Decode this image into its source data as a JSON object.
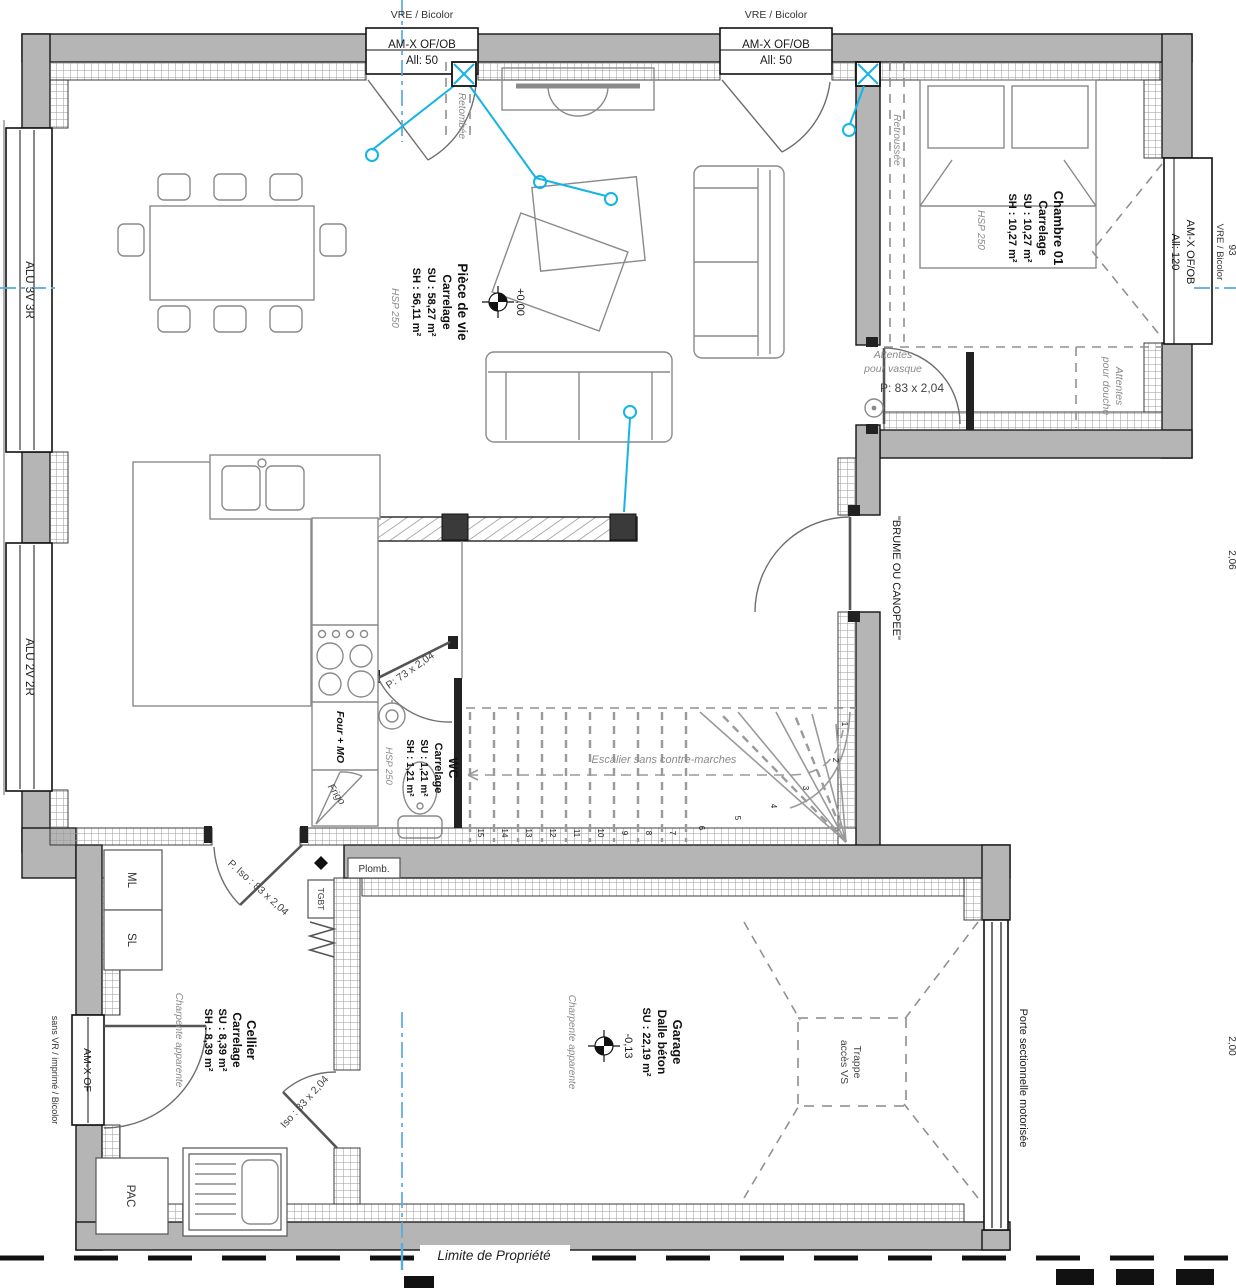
{
  "rooms": {
    "piece_de_vie": {
      "name": "Pièce de vie",
      "finish": "Carrelage",
      "su": "SU : 58,27 m²",
      "sh": "SH : 56,11 m²",
      "hsp": "HSP 250"
    },
    "chambre": {
      "name": "Chambre 01",
      "finish": "Carrelage",
      "su": "SU : 10,27 m²",
      "sh": "SH : 10,27 m²",
      "hsp": "HSP 250"
    },
    "wc": {
      "name": "WC",
      "finish": "Carrelage",
      "su": "SU : 1,21 m²",
      "sh": "SH : 1,21 m²",
      "hsp": "HSP 250"
    },
    "cellier": {
      "name": "Cellier",
      "finish": "Carrelage",
      "su": "SU : 8,39 m²",
      "sh": "SH : 8,39 m²",
      "note": "Charpente apparente"
    },
    "garage": {
      "name": "Garage",
      "finish": "Dalle béton",
      "su": "SU : 22,19 m²",
      "note": "Charpente apparente"
    }
  },
  "levels": {
    "main": "+0,00",
    "garage": "-0,13"
  },
  "windows": {
    "top_left": {
      "head": "VRE / Bicolor",
      "label": "AM-X OF/OB",
      "sill": "All: 50"
    },
    "top_right": {
      "head": "VRE / Bicolor",
      "label": "AM-X OF/OB",
      "sill": "All: 50"
    },
    "east": {
      "head": "VRE / Bicolor",
      "label": "AM-X OF/OB",
      "sill": "All: 120"
    },
    "west_large": {
      "label": "ALU 3V 3R"
    },
    "west_small": {
      "label": "ALU 2V 2R"
    },
    "cellier": {
      "label": "AM-X OF",
      "note": "sans VR / imprimé / Bicolor"
    }
  },
  "doors": {
    "entry": "\"BRUME OU CANOPEE\"",
    "garage": "Porte sectionnelle motorisée",
    "wc": "P: 73 x 2,04",
    "suite": "P: 83 x 2,04",
    "cellier": "P. Iso : 83 x 2,04",
    "cellier_garage": "Iso : 83 x 2,04"
  },
  "annotations": {
    "retombee": "Retombée",
    "retroussee": "Retroussée",
    "vasque_1": "Attentes",
    "vasque_2": "pour vasque",
    "douche_1": "Attentes",
    "douche_2": "pour douche",
    "stairs": "Escalier sans contre-marches",
    "trappe_1": "Trappe",
    "trappe_2": "accès VS",
    "plomb": "Plomb.",
    "tgbt": "TGBT",
    "ml": "ML",
    "sl": "SL",
    "pac": "PAC",
    "four": "Four + MO",
    "frigo": "Frigo",
    "limite": "Limite de Propriété"
  },
  "stairs": {
    "numbers": [
      "15",
      "14",
      "13",
      "12",
      "11",
      "10",
      "9",
      "8",
      "7",
      "6",
      "5",
      "4",
      "3",
      "2",
      "1"
    ]
  },
  "dims": {
    "right_top": "93",
    "right_mid": "2,06",
    "right_bottom": "2,00"
  },
  "colors": {
    "wall": "#b5b5b5",
    "hatch": "#9a9a9a",
    "cyan": "#14b4e6",
    "centerline": "#5aa9e0"
  }
}
